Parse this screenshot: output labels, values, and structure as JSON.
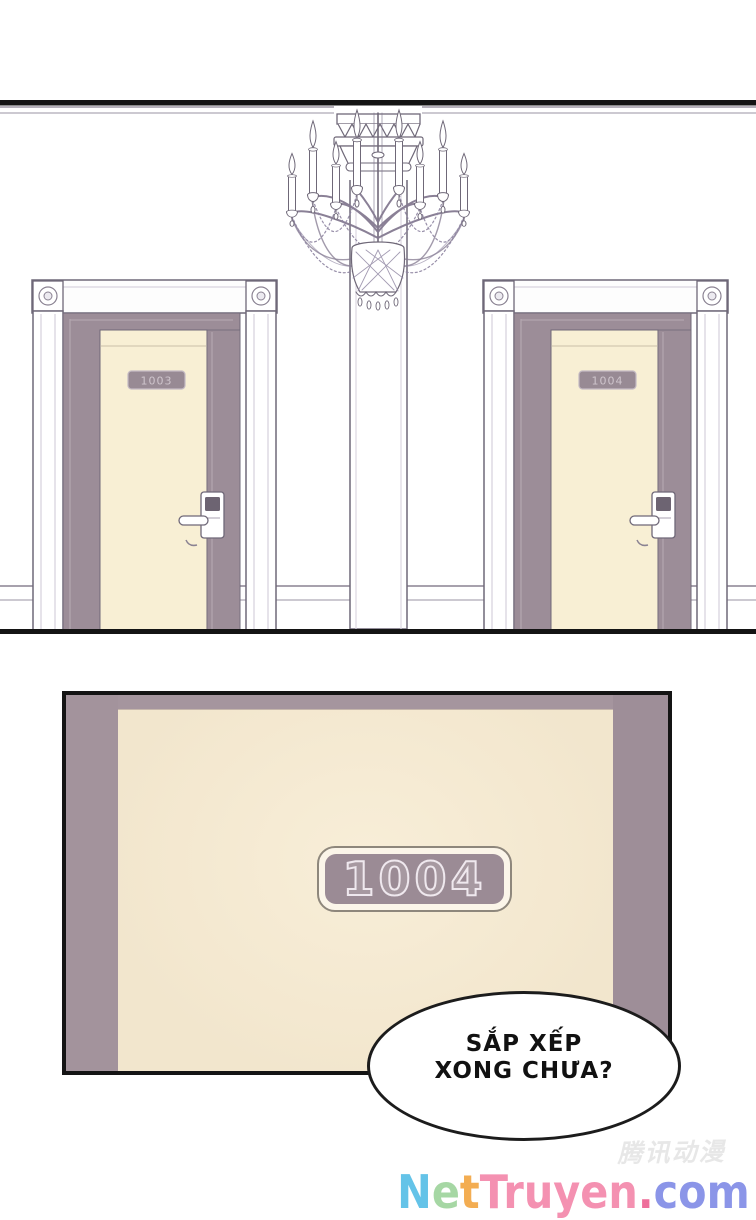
{
  "panel1": {
    "doors": [
      {
        "name": "door-left",
        "plate": "1003"
      },
      {
        "name": "door-right",
        "plate": "1004"
      }
    ]
  },
  "panel2": {
    "plate": "1004"
  },
  "speech_bubble": {
    "line1": "SẮP XẾP",
    "line2": "XONG CHƯA?"
  },
  "watermark": {
    "text": "腾讯动漫"
  },
  "footer_logo": {
    "text": "NetTruyen.com",
    "letters": [
      {
        "ch": "N",
        "color": "#64c3e8"
      },
      {
        "ch": "e",
        "color": "#a6d7a4"
      },
      {
        "ch": "t",
        "color": "#f3ad52"
      },
      {
        "ch": "T",
        "color": "#f491b1"
      },
      {
        "ch": "r",
        "color": "#f491b1"
      },
      {
        "ch": "u",
        "color": "#f491b1"
      },
      {
        "ch": "y",
        "color": "#f491b1"
      },
      {
        "ch": "e",
        "color": "#f491b1"
      },
      {
        "ch": "n",
        "color": "#f491b1"
      },
      {
        "ch": ".",
        "color": "#ee6f9b"
      },
      {
        "ch": "c",
        "color": "#8b95e8"
      },
      {
        "ch": "o",
        "color": "#8b95e8"
      },
      {
        "ch": "m",
        "color": "#8b95e8"
      }
    ]
  },
  "colors": {
    "door_cream": "#f8efd4",
    "frame_mauve": "#9c8d98",
    "line_dark": "#6f6878",
    "panel_border": "#141414"
  }
}
